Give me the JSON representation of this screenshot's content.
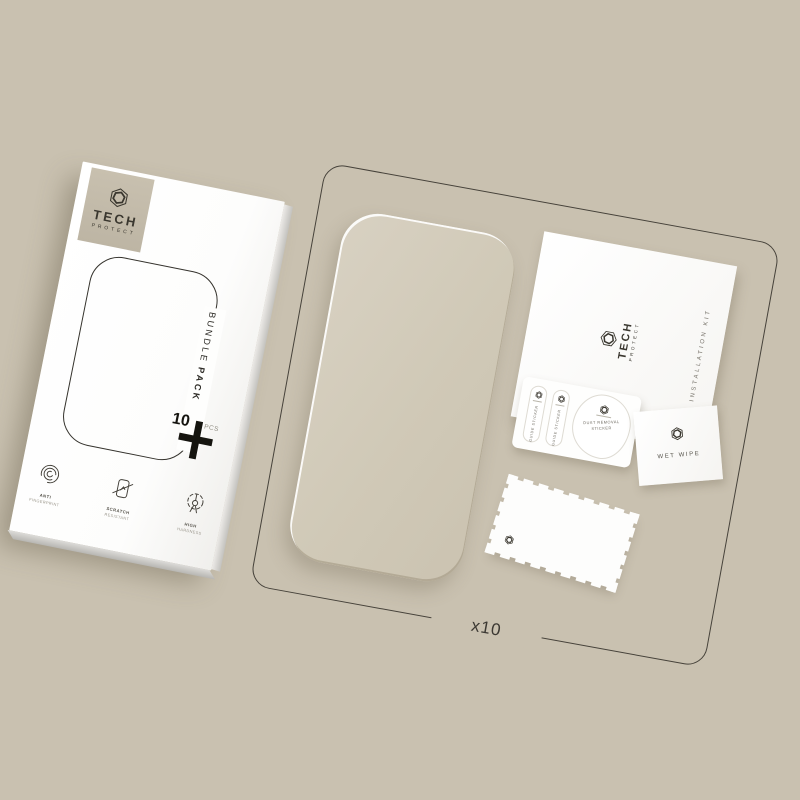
{
  "scene": {
    "background_color": "#c9c1b0",
    "accent_color": "#3a372f",
    "glass_tint": "#d2cbba"
  },
  "box": {
    "brand": {
      "name": "TECH",
      "sub": "PROTECT"
    },
    "side_label": {
      "word1": "BUNDLE",
      "word2": "PACK"
    },
    "count": "10",
    "count_unit": "PCS",
    "features": [
      {
        "icon": "fingerprint-icon",
        "line1": "ANTI",
        "line2": "FINGERPRINT"
      },
      {
        "icon": "scratch-icon",
        "line1": "SCRATCH",
        "line2": "RESISTANT"
      },
      {
        "icon": "hardness-icon",
        "line1": "HIGH",
        "line2": "HARDNESS"
      }
    ]
  },
  "kit": {
    "quantity_label": "x10",
    "instruction_card": {
      "brand": "TECH",
      "brand_sub": "PROTECT",
      "side_text": "INSTALLATION KIT"
    },
    "stickers": {
      "guides": [
        "GUIDE STICKER",
        "GUIDE STICKER"
      ],
      "dust_line1": "DUST REMOVAL",
      "dust_line2": "STICKER"
    },
    "wet_wipe": {
      "label": "WET WIPE"
    }
  }
}
